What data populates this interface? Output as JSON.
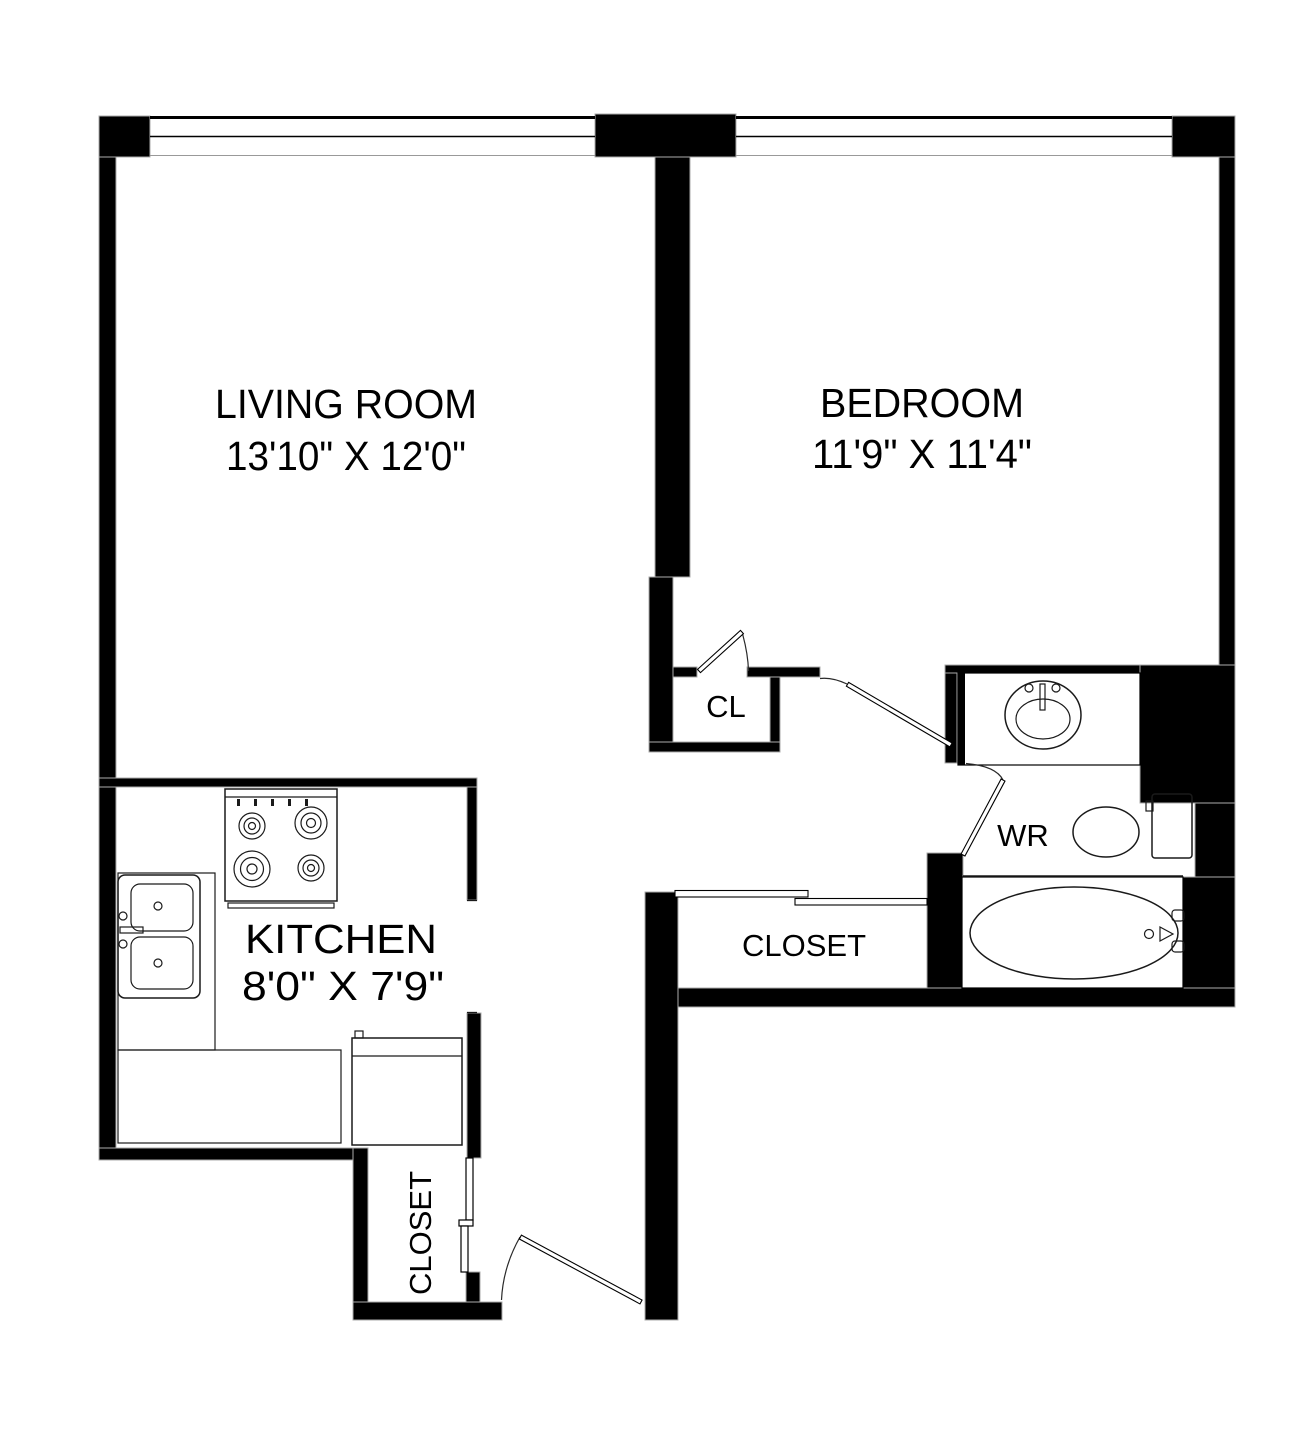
{
  "colors": {
    "background": "#ffffff",
    "wall": "#000000",
    "fixture_line": "#1a1a1a",
    "shadow_line": "#ababab"
  },
  "rooms": {
    "living_room": {
      "label": "LIVING ROOM",
      "dimensions": "13'10\" X 12'0\""
    },
    "bedroom": {
      "label": "BEDROOM",
      "dimensions": "11'9\" X 11'4\""
    },
    "kitchen": {
      "label": "KITCHEN",
      "dimensions": "8'0\" X 7'9\""
    },
    "bedroom_closet": {
      "label": "CL"
    },
    "washroom": {
      "label": "WR"
    },
    "hall_closet": {
      "label": "CLOSET"
    },
    "entry_closet": {
      "label": "CLOSET"
    }
  },
  "fixtures": [
    "stove",
    "kitchen-double-sink",
    "refrigerator",
    "kitchen-counter",
    "vanity-sink",
    "toilet",
    "bathtub",
    "living-room-window",
    "bedroom-window",
    "bedroom-door",
    "washroom-door",
    "bedroom-closet-door",
    "entry-door",
    "hall-closet-sliding-door"
  ]
}
